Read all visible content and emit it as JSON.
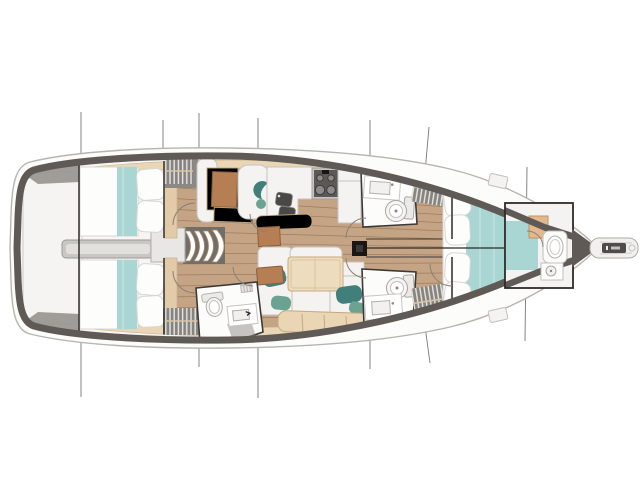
{
  "diagram": {
    "type": "sailboat-interior-floor-plan",
    "orientation": "bow-right",
    "areas": [
      "transom-platform",
      "aft-cabin-starboard",
      "aft-cabin-port",
      "engine-compartment",
      "companionway-steps",
      "nav-station",
      "galley",
      "salon-dinette",
      "aft-head",
      "midship-head-starboard",
      "midship-head-port",
      "wardrobe-lockers",
      "forward-cabin",
      "forward-head",
      "foredeck-hatches",
      "mast",
      "bowsprit"
    ],
    "fixtures": [
      "double-berth",
      "pillows",
      "aqua-bed-runner",
      "stove-with-burners",
      "double-sink",
      "fridge-cabinet",
      "dinette-table",
      "u-shaped-settee",
      "toilet",
      "washbasin",
      "shower",
      "chart-table",
      "door-swing-arcs",
      "section-lines",
      "rigging-lines"
    ]
  },
  "colors": {
    "hull_dark": "#5f5a56",
    "rail_stroke": "#b7b4b0",
    "rail_fill": "#fcfcfb",
    "deck": "#f6f5f3",
    "wood": "#c4a485",
    "plank_line": "#7d5c39",
    "rim_beige": "#e8d6b6",
    "rim_edge": "#cfb68f",
    "furn_white": "#f4f3f1",
    "furn_edge": "#c6c3c0",
    "bed_white": "#fdfdfc",
    "bed_edge": "#d8d6d3",
    "aqua": "#a9d5d3",
    "headboard": "#e3cba9",
    "engine_gray": "#c9c7c4",
    "locker_gray": "#87847f",
    "table_brown": "#b57f53",
    "teal_dark": "#41807a",
    "teal_light": "#6ba393",
    "sink_dark": "#4a4846",
    "stove_dark": "#5b5855",
    "table_beige": "#eedcbe",
    "bench_beige": "#ead6b4",
    "outline_dark": "#3c3936",
    "section_line": "#7a7672",
    "arc_line": "#8a8175"
  }
}
